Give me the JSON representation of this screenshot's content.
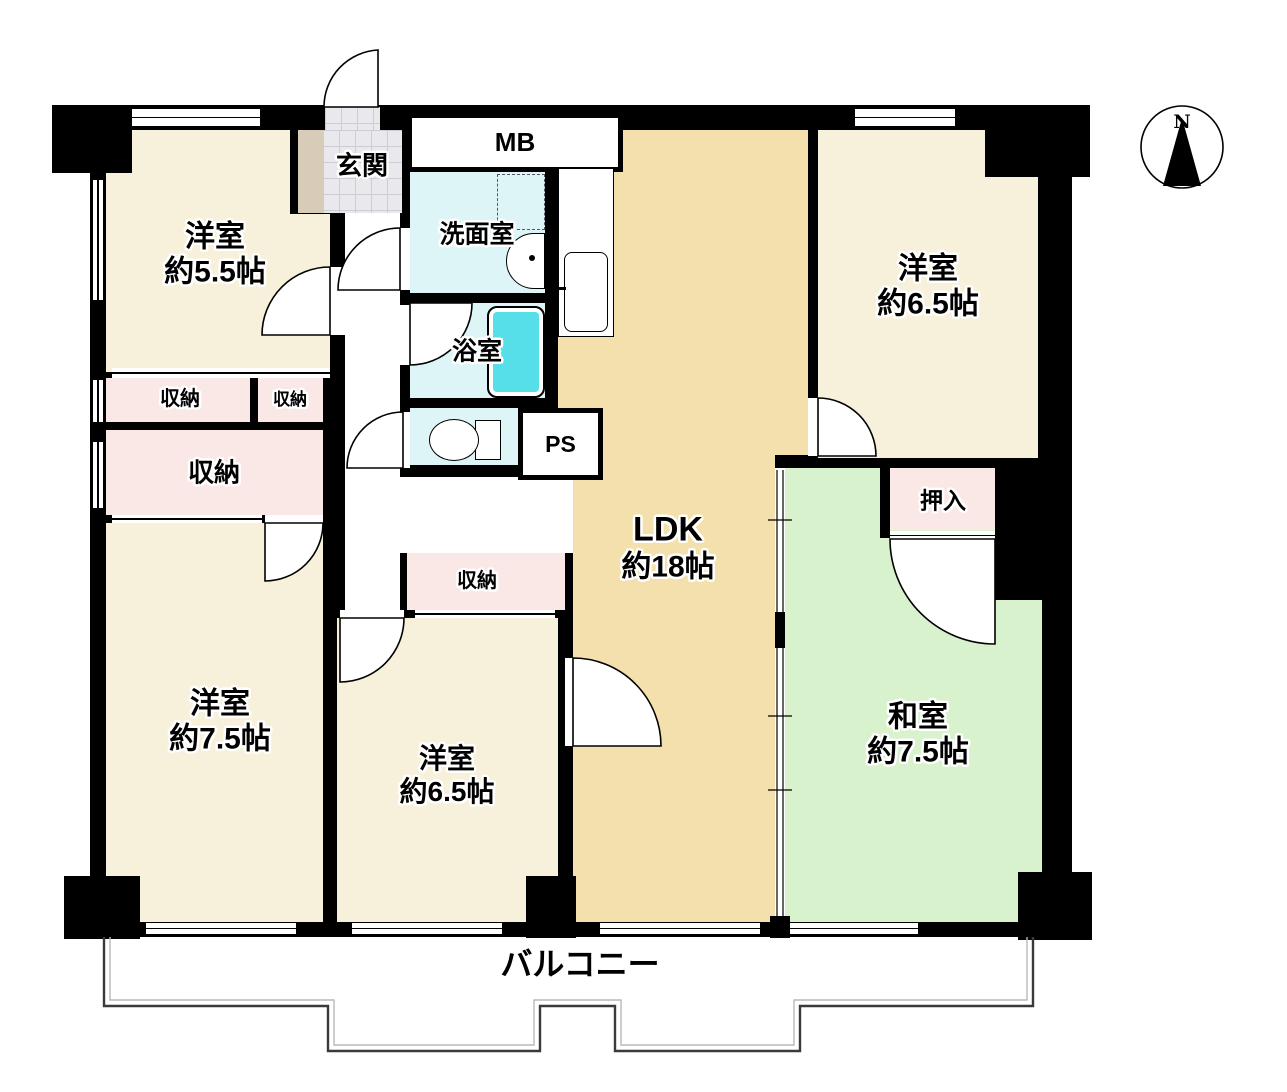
{
  "floorplan": {
    "title": "apartment-floor-plan",
    "compass": {
      "label": "N"
    },
    "balcony": {
      "label": "バルコニー"
    },
    "rooms": {
      "bedroom_nw": {
        "name": "洋室",
        "size": "約5.5帖"
      },
      "bedroom_ne": {
        "name": "洋室",
        "size": "約6.5帖"
      },
      "bedroom_sw": {
        "name": "洋室",
        "size": "約7.5帖"
      },
      "bedroom_s": {
        "name": "洋室",
        "size": "約6.5帖"
      },
      "washitsu": {
        "name": "和室",
        "size": "約7.5帖"
      },
      "ldk": {
        "name": "LDK",
        "size": "約18帖"
      },
      "genkan": {
        "label": "玄関"
      },
      "senmen": {
        "label": "洗面室"
      },
      "bath": {
        "label": "浴室"
      },
      "mb": {
        "label": "MB"
      },
      "ps": {
        "label": "PS"
      },
      "closet_1": {
        "label": "収納"
      },
      "closet_2": {
        "label": "収納"
      },
      "closet_big": {
        "label": "収納"
      },
      "closet_mid": {
        "label": "収納"
      },
      "oshiire": {
        "label": "押入"
      }
    },
    "colors": {
      "wall": "#000000",
      "western_room": "#F7F0DB",
      "ldk": "#F3E0AC",
      "tatami_room": "#D8F2CE",
      "closet": "#FAE8E6",
      "wet_area": "#DEF5F8",
      "bathtub": "#56DFE9",
      "entry_tile": "#E9E9ED",
      "shoe_cabinet": "#D8CCB9"
    }
  }
}
